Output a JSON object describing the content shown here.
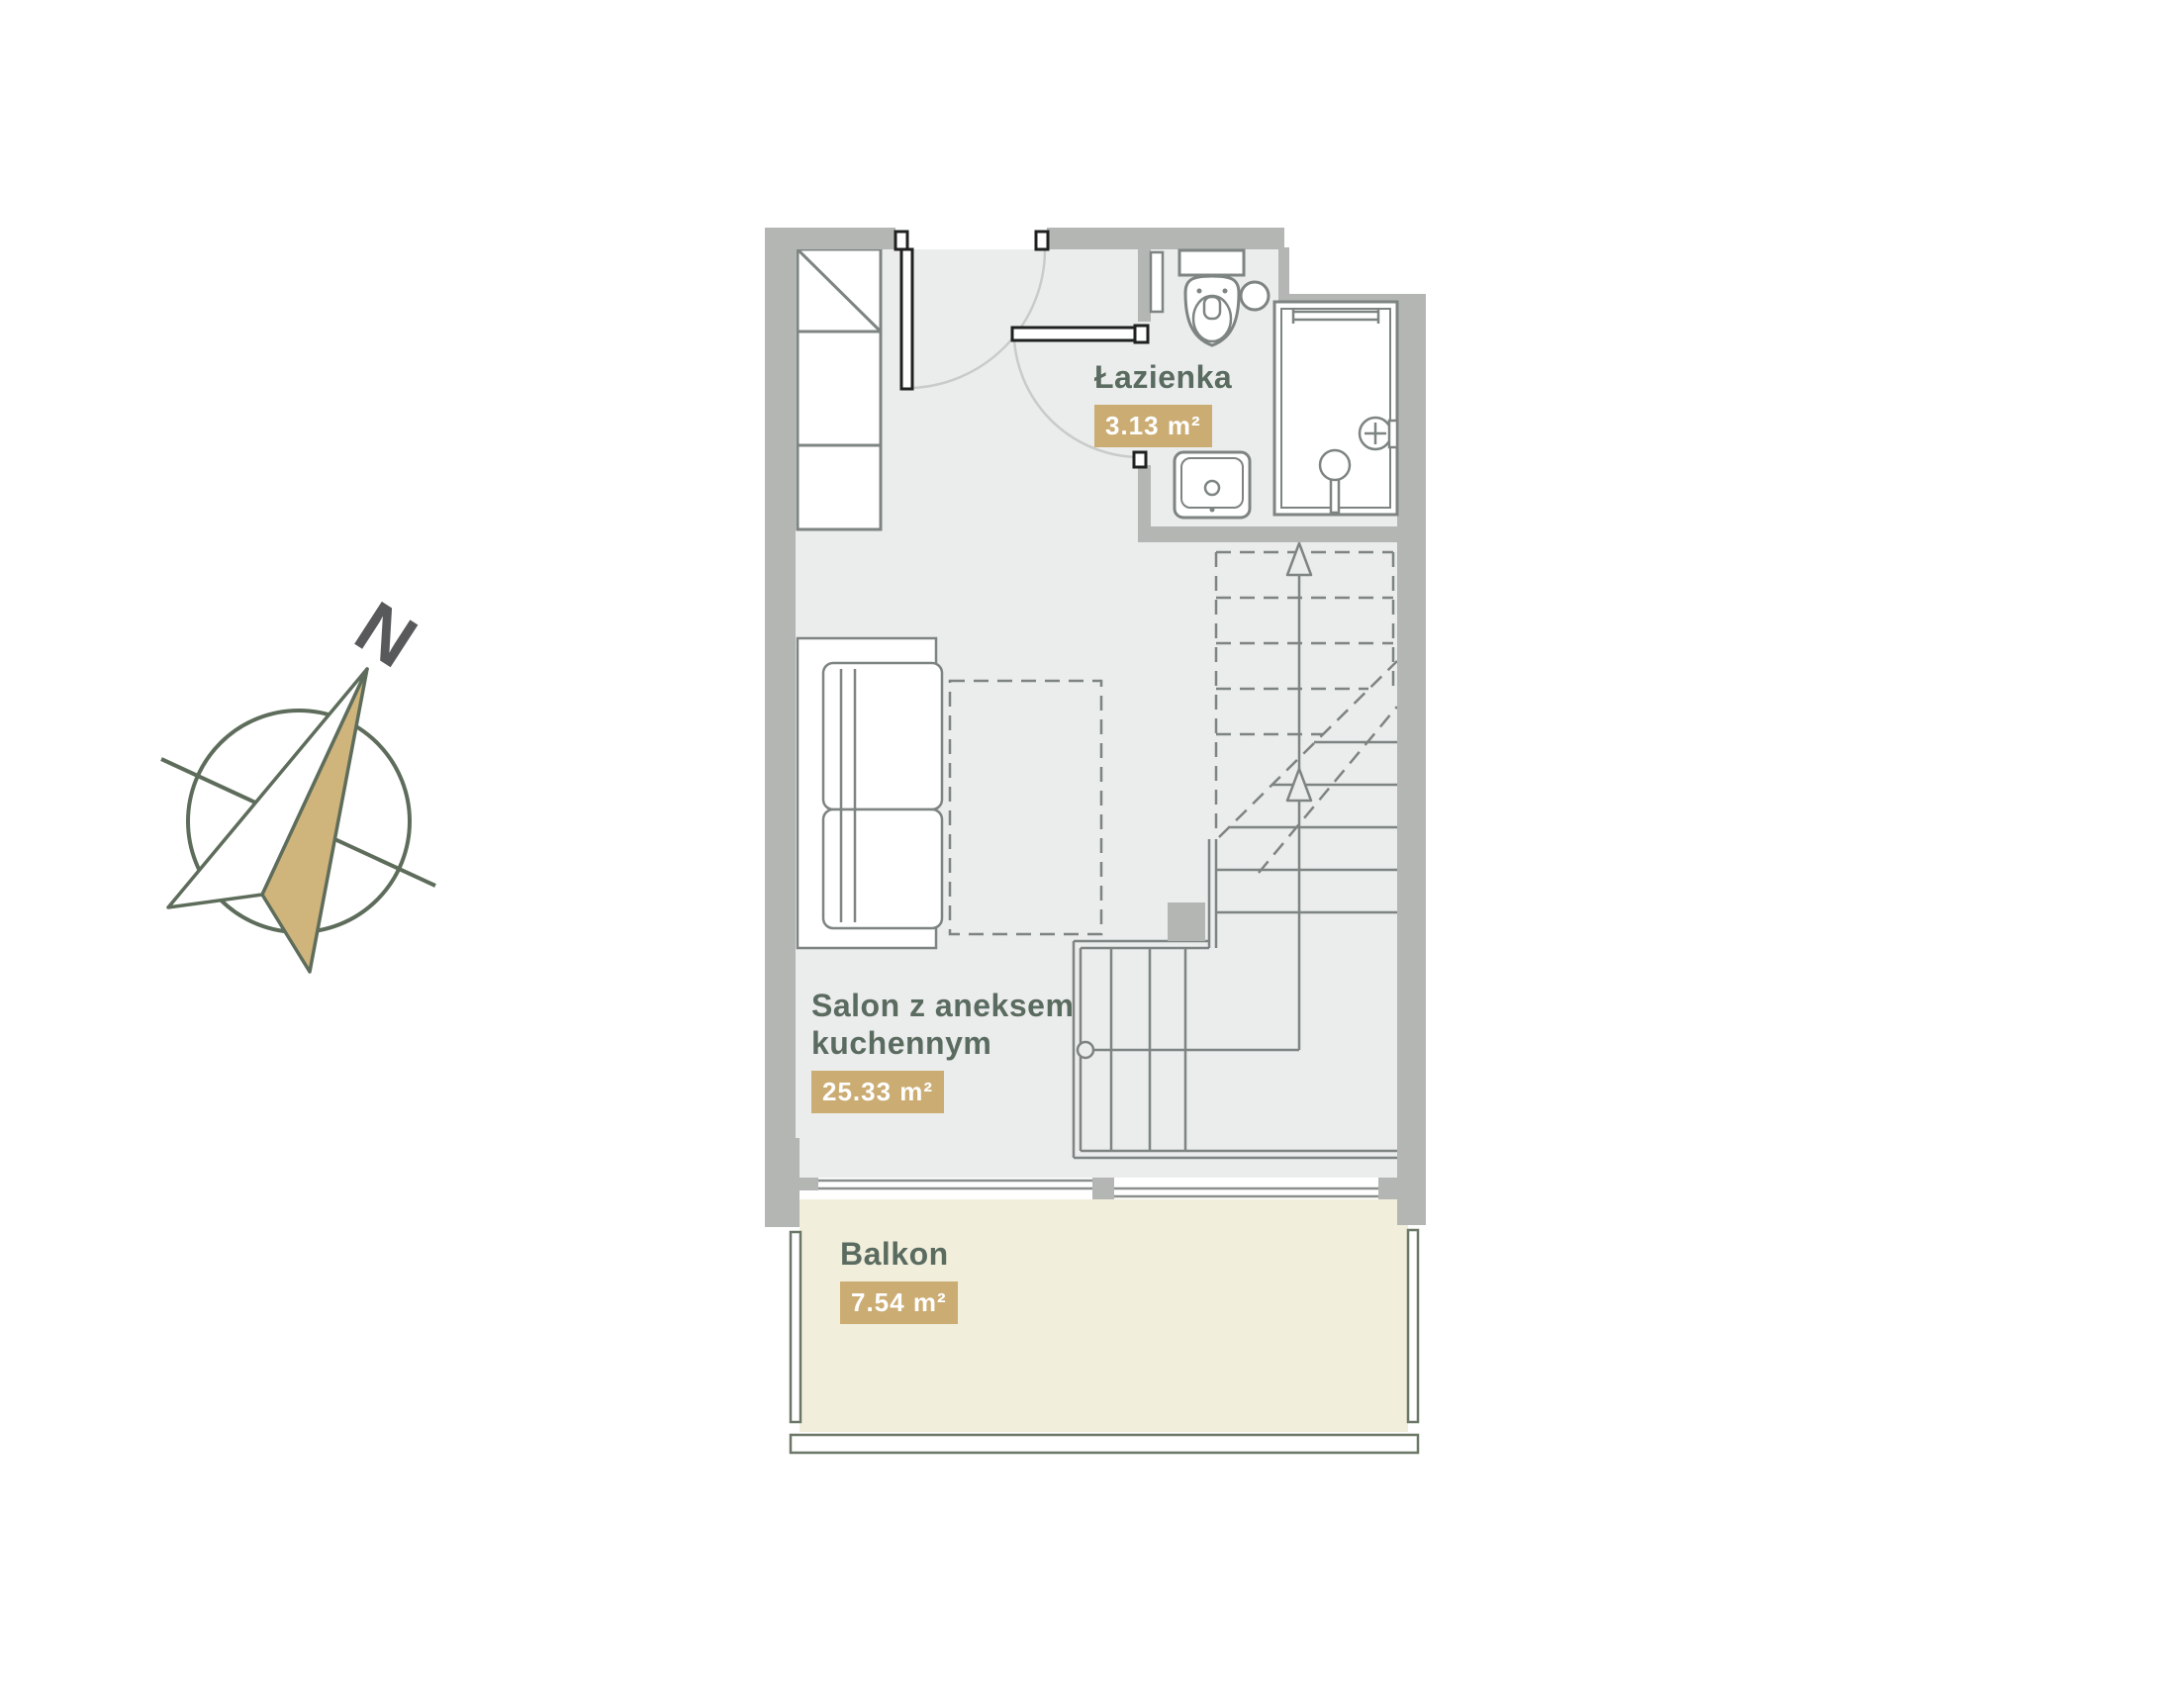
{
  "title": "Apartment floor plan",
  "colors": {
    "wall": "#b4b6b4",
    "floor": "#ebecec",
    "furniture_line": "#7d8481",
    "door_line": "#1f2020",
    "door_swing_arc": "#c9cbca",
    "balcony_floor": "#f2eedc",
    "balcony_line": "#6b7767",
    "label_text": "#5a6b60",
    "badge_background": "#cbac73",
    "badge_text": "#ffffff",
    "compass_line": "#5e6d5b",
    "compass_needle_fill": "#cfb47c",
    "compass_north_text": "#58595b"
  },
  "compass": {
    "north_label": "N"
  },
  "rooms": {
    "lazienka": {
      "name": "Łazienka",
      "area": "3.13 m²"
    },
    "salon": {
      "name_line1": "Salon z aneksem",
      "name_line2": "kuchennym",
      "area": "25.33 m²"
    },
    "balkon": {
      "name": "Balkon",
      "area": "7.54 m²"
    }
  }
}
